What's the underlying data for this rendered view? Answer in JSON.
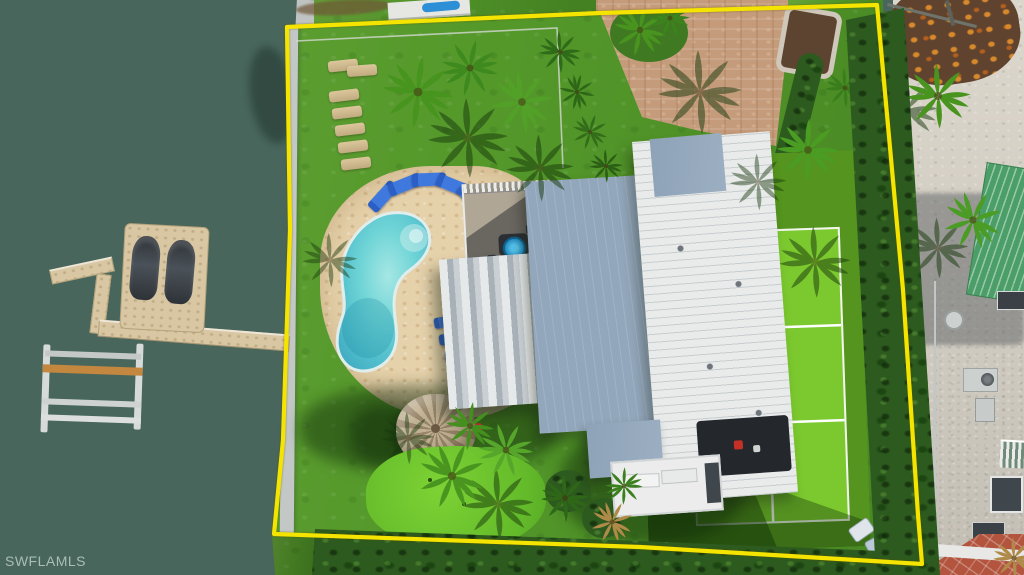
{
  "watermark": {
    "text": "SWFLAMLS"
  },
  "photo": {
    "kind": "aerial-drone-photo",
    "subject": "waterfront home lot outlined in yellow",
    "boundary_color": "#f5e400",
    "colors": {
      "water": "#48665c",
      "lawn": "#54982a",
      "tennis_court": "#7cc92f",
      "pool": "#63ccd2",
      "pool_deck": "#e5d1aa",
      "paver_driveway": "#c59c7b",
      "roof_gray_blue": "#93a7bc",
      "roof_white": "#e9ebeb",
      "neighbor_green_roof": "#4c9e68",
      "hedge": "#2d5a1e",
      "dock": "#d8c7a2",
      "thatch_hut": "#bdac8e"
    },
    "objects": [
      "canal water",
      "floating dock with two jet skis",
      "boat lift",
      "seawall",
      "yellow property boundary",
      "artificial turf lawn",
      "kidney-shaped pool",
      "pool deck with blue loungers",
      "row of tan loungers",
      "metal roof house",
      "patio with blue umbrella",
      "tennis court",
      "paver driveway",
      "thatched tiki hut",
      "putting green",
      "palm trees",
      "neighboring house with green metal roof",
      "hedge rows"
    ]
  }
}
